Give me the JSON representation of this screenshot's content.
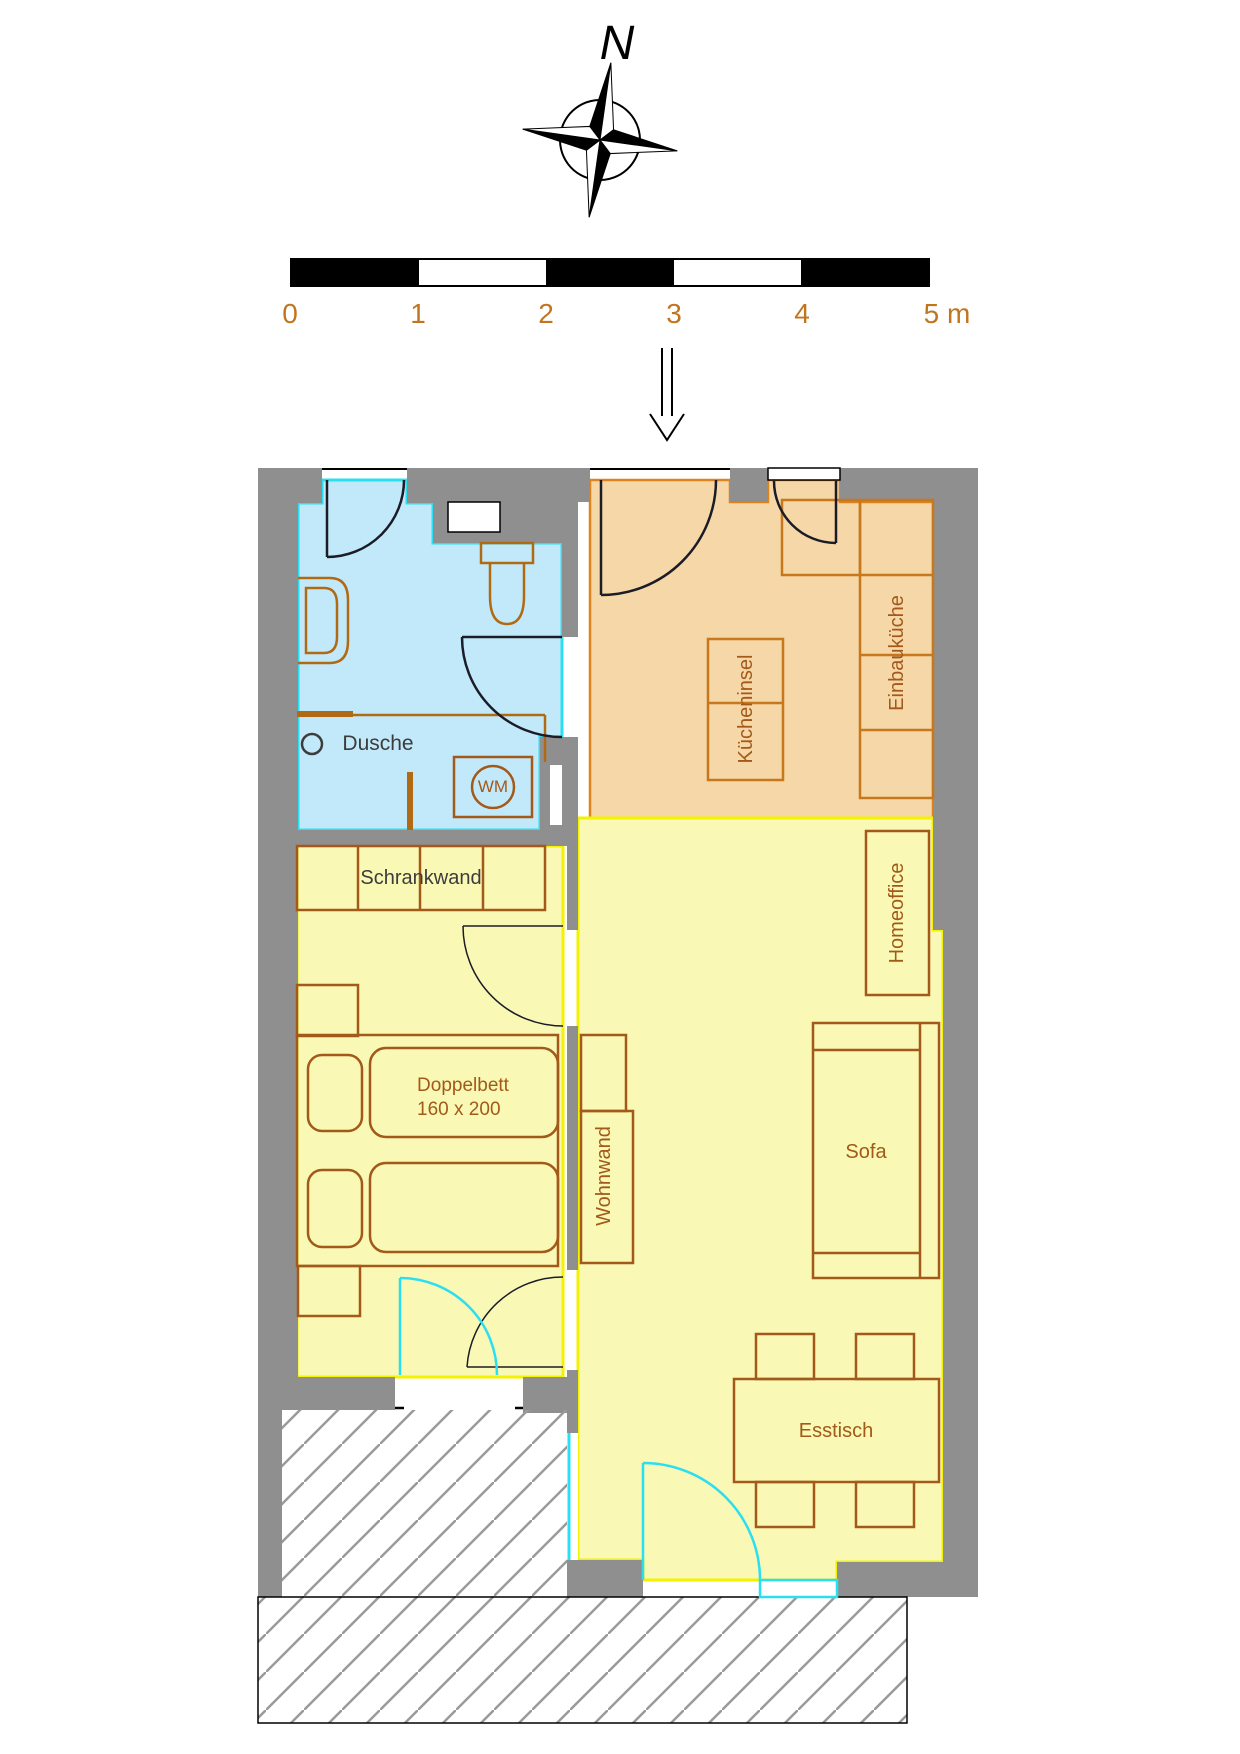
{
  "compass": {
    "label": "N"
  },
  "scale_bar": {
    "unit_labels": [
      "0",
      "1",
      "2",
      "3",
      "4",
      "5 m"
    ]
  },
  "rooms": {
    "bathroom": {
      "shower_label": "Dusche",
      "washing_machine_label": "WM"
    },
    "kitchen": {
      "island_label": "Kücheninsel",
      "builtin_kitchen_label": "Einbauküche"
    },
    "bedroom": {
      "wardrobe_label": "Schrankwand",
      "bed_label_line1": "Doppelbett",
      "bed_label_line2": "160 x 200"
    },
    "living_room": {
      "home_office_label": "Homeoffice",
      "sofa_label": "Sofa",
      "tv_wall_label": "Wohnwand",
      "dining_table_label": "Esstisch"
    }
  },
  "colors": {
    "wall_gray": "#8f8f8f",
    "bathroom_fill": "#c2e9f9",
    "bathroom_border": "#2bdff2",
    "kitchen_fill": "#f6d7a7",
    "kitchen_border": "#df831f",
    "room_yellow_fill": "#f9f9b5",
    "room_yellow_border": "#f2f201",
    "furniture_brown": "#a2591a",
    "kitchen_furniture_orange": "#c8781c",
    "scale_text_orange": "#c2751f",
    "dark_text": "#3c3c3c",
    "door_arc_black": "#1c1c28"
  }
}
